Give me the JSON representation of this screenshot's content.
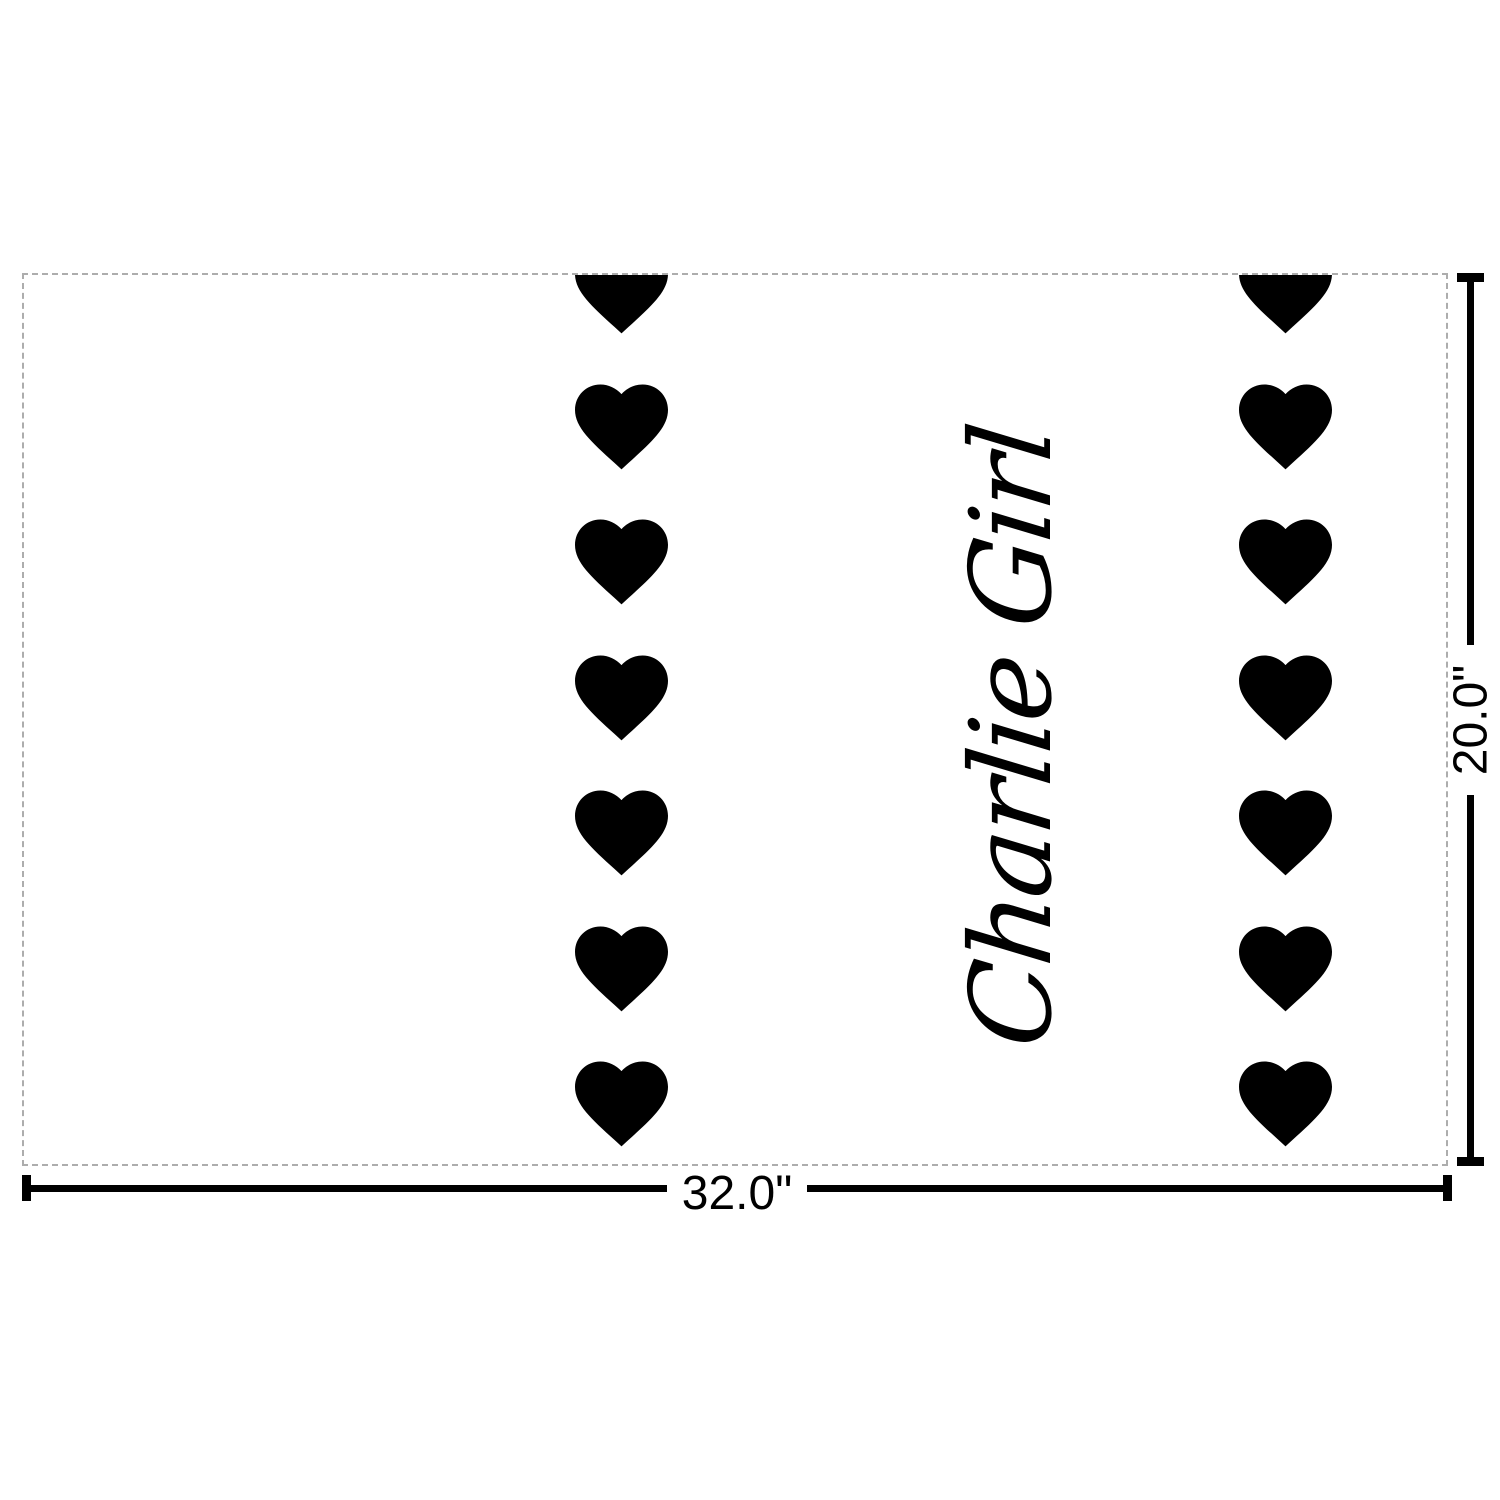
{
  "page": {
    "background": "#ffffff"
  },
  "product_preview": {
    "personalization_text": "Charlie Girl",
    "text_color": "#000000",
    "canvas_background": "#ffffff",
    "edge_color": "#adadad",
    "pattern_name": "vertical heart stripes",
    "heart_color": "#000000",
    "heart_columns": 2,
    "hearts_per_column": 7
  },
  "icons": {
    "heart": "♥"
  },
  "dimension_rulers": {
    "color": "#000000",
    "width_label": "32.0\"",
    "height_label": "20.0\""
  }
}
